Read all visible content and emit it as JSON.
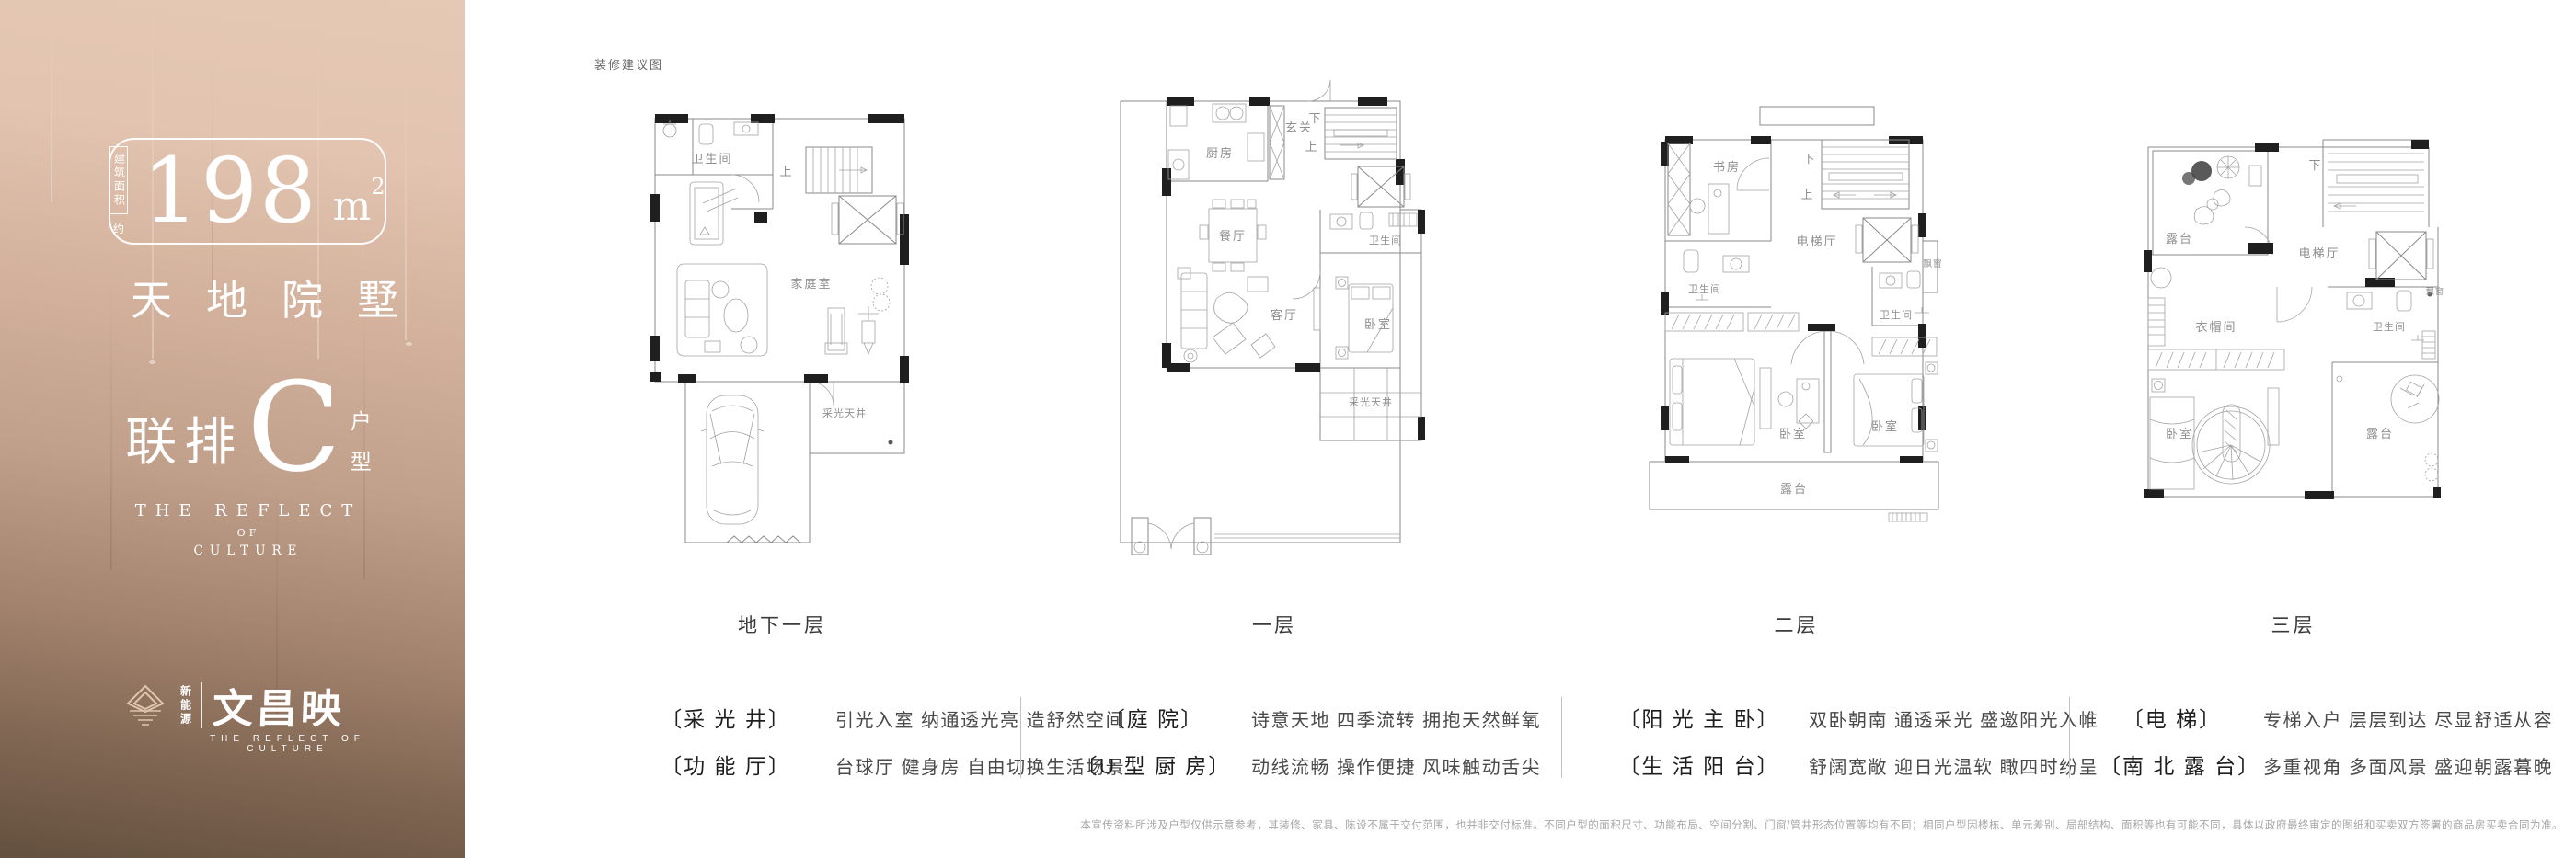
{
  "panel": {
    "area_box_label": "建筑面积",
    "area_approx": "约",
    "area_value": "198",
    "area_unit": "m",
    "area_sup": "2",
    "title": "天地院墅",
    "type_prefix": "联排",
    "type_letter": "C",
    "type_char1": "户",
    "type_char2": "型",
    "sub1": "THE REFLECT",
    "sub2": "OF",
    "sub3": "CULTURE",
    "logo_vertical": "新能源",
    "logo_name": "文昌映",
    "logo_tagline": "THE REFLECT OF CULTURE"
  },
  "note": "装修建议图",
  "plans": [
    {
      "label": "地下一层",
      "rooms": {
        "bath": "卫生间",
        "up": "上",
        "family": "家庭室",
        "lightwell": "采光天井"
      }
    },
    {
      "label": "一层",
      "rooms": {
        "kitchen": "厨房",
        "foyer": "玄关",
        "down": "下",
        "up": "上",
        "dining": "餐厅",
        "living": "客厅",
        "bath": "卫生间",
        "bedroom": "卧室",
        "lightwell": "采光天井"
      }
    },
    {
      "label": "二层",
      "rooms": {
        "study": "书房",
        "down": "下",
        "up": "上",
        "hall": "电梯厅",
        "bath1": "卫生间",
        "bath2": "卫生间",
        "bay": "飘窗",
        "bed1": "卧室",
        "bed2": "卧室",
        "terrace": "露台"
      }
    },
    {
      "label": "三层",
      "rooms": {
        "terrace1": "露台",
        "down": "下",
        "hall": "电梯厅",
        "cloak": "衣帽间",
        "bath": "卫生间",
        "bed": "卧室",
        "terrace2": "露台",
        "bay": "飘窗"
      }
    }
  ],
  "features": [
    {
      "rows": [
        {
          "tag": "〔采 光 井〕",
          "desc": "引光入室 纳通透光亮 造舒然空间"
        },
        {
          "tag": "〔功 能 厅〕",
          "desc": "台球厅 健身房 自由切换生活场景"
        }
      ]
    },
    {
      "rows": [
        {
          "tag": "〔庭 院〕",
          "desc": "诗意天地 四季流转 拥抱天然鲜氧"
        },
        {
          "tag": "〔U 型 厨 房〕",
          "desc": "动线流畅 操作便捷 风味触动舌尖"
        }
      ]
    },
    {
      "rows": [
        {
          "tag": "〔阳 光 主 卧〕",
          "desc": "双卧朝南 通透采光 盛邀阳光入帷"
        },
        {
          "tag": "〔生 活 阳 台〕",
          "desc": "舒阔宽敞 迎日光温软 瞰四时纷呈"
        }
      ]
    },
    {
      "rows": [
        {
          "tag": "〔电 梯〕",
          "desc": "专梯入户 层层到达 尽显舒适从容"
        },
        {
          "tag": "〔南 北 露 台〕",
          "desc": "多重视角 多面风景 盛迎朝露暮晚"
        }
      ]
    }
  ],
  "disclaimer": "本宣传资料所涉及户型仅供示意参考，其装修、家具、陈设不属于交付范围，也并非交付标准。不同户型的面积尺寸、功能布局、空间分割、门窗/管井形态位置等均有不同；相同户型因楼栋、单元差别、局部结构、面积等也有可能不同，具体以政府最终审定的图纸和买卖双方签署的商品房买卖合同为准。",
  "colors": {
    "panel_top": "#e5c9b5",
    "panel_bottom": "#64503f",
    "panel_text": "#ffffff",
    "plan_line": "#8a8a8a",
    "plan_wall": "#1f1f1f",
    "feature_tag": "#1e1e1e",
    "feature_desc": "#4a4a4a",
    "disclaimer_gray": "#a6a6a6"
  }
}
